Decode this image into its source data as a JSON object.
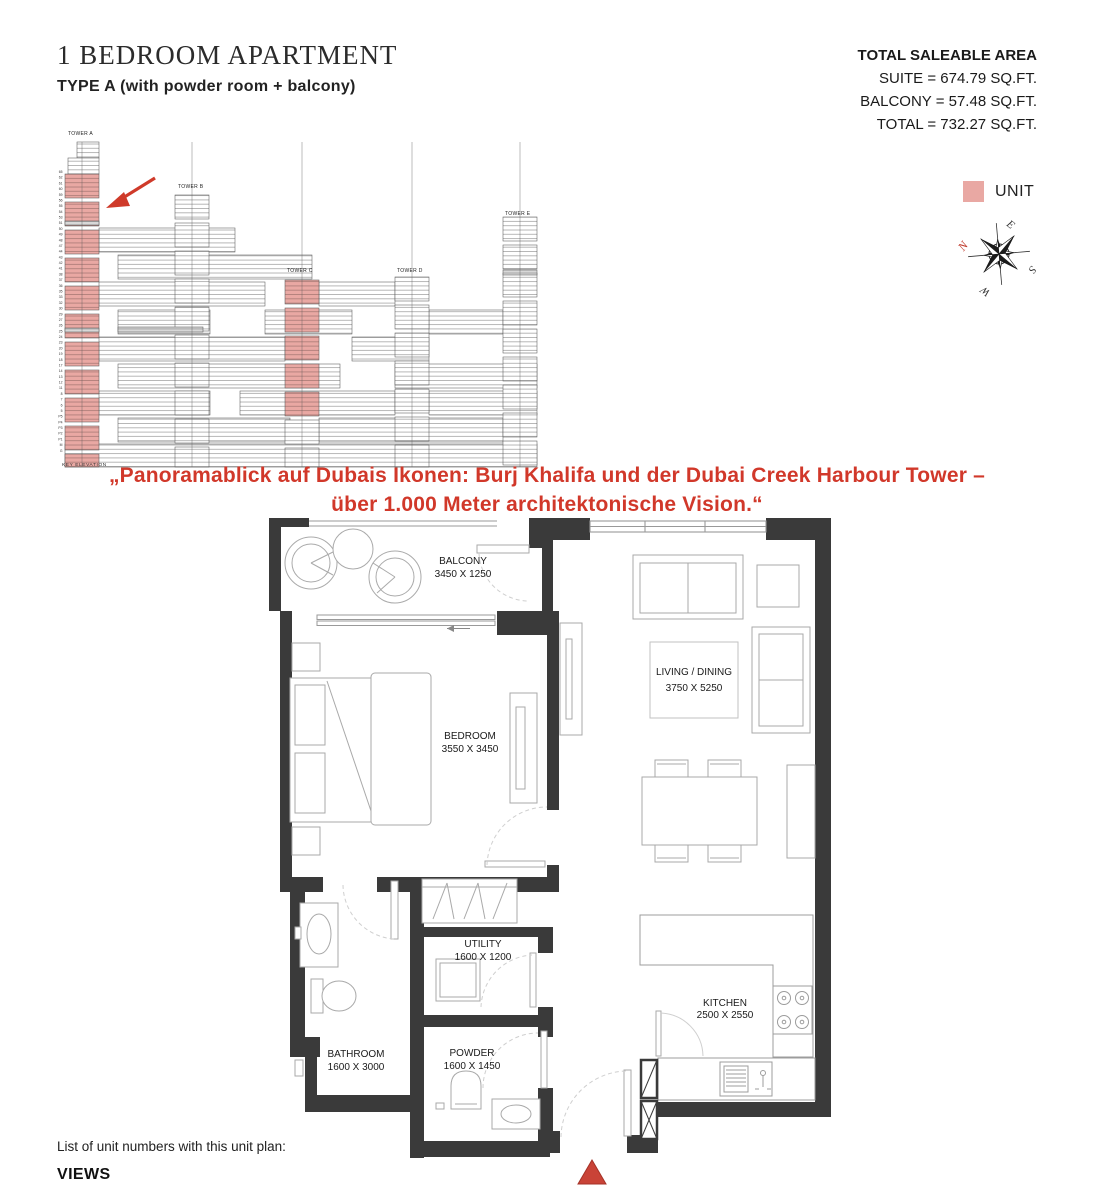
{
  "header": {
    "title": "1 BEDROOM APARTMENT",
    "subtitle": "TYPE A (with powder room + balcony)"
  },
  "area_summary": {
    "heading": "TOTAL SALEABLE AREA",
    "suite": "SUITE = 674.79 SQ.FT.",
    "balcony": "BALCONY = 57.48 SQ.FT.",
    "total": "TOTAL = 732.27 SQ.FT."
  },
  "legend": {
    "unit_label": "UNIT"
  },
  "compass": {
    "n": "N",
    "e": "E",
    "s": "S",
    "w": "W"
  },
  "key_elevation": {
    "caption": "KEY ELEVATION",
    "towers": [
      "TOWER A",
      "TOWER B",
      "TOWER C",
      "TOWER D",
      "TOWER E"
    ],
    "floor_labels": [
      "65",
      "62",
      "61",
      "60",
      "59",
      "56",
      "55",
      "54",
      "53",
      "51",
      "50",
      "49",
      "48",
      "47",
      "44",
      "43",
      "42",
      "41",
      "38",
      "37",
      "36",
      "35",
      "33",
      "32",
      "30",
      "29",
      "27",
      "26",
      "25",
      "24",
      "23",
      "20",
      "19",
      "18",
      "17",
      "14",
      "13",
      "12",
      "11",
      "8",
      "7",
      "6",
      "5",
      "P5",
      "P4",
      "P3",
      "P2",
      "P1",
      "M",
      "G"
    ]
  },
  "caption": {
    "line1": "„Panoramablick auf Dubais Ikonen: Burj Khalifa und der Dubai Creek Harbour Tower –",
    "line2": "über 1.000 Meter architektonische Vision.“"
  },
  "rooms": {
    "balcony": {
      "name": "BALCONY",
      "dims": "3450 X 1250"
    },
    "bedroom": {
      "name": "BEDROOM",
      "dims": "3550 X 3450"
    },
    "living": {
      "name": "LIVING / DINING",
      "dims": "3750 X 5250"
    },
    "utility": {
      "name": "UTILITY",
      "dims": "1600 X 1200"
    },
    "bathroom": {
      "name": "BATHROOM",
      "dims": "1600 X 3000"
    },
    "powder": {
      "name": "POWDER",
      "dims": "1600 X 1450"
    },
    "kitchen": {
      "name": "KITCHEN",
      "dims": "2500 X 2550"
    }
  },
  "footer": {
    "list_label": "List of unit numbers with this unit plan:",
    "views_label": "VIEWS"
  },
  "colors": {
    "unit_pink": "#e9a8a3",
    "accent_red": "#d1382a",
    "wall_dark": "#3a3a3a"
  }
}
